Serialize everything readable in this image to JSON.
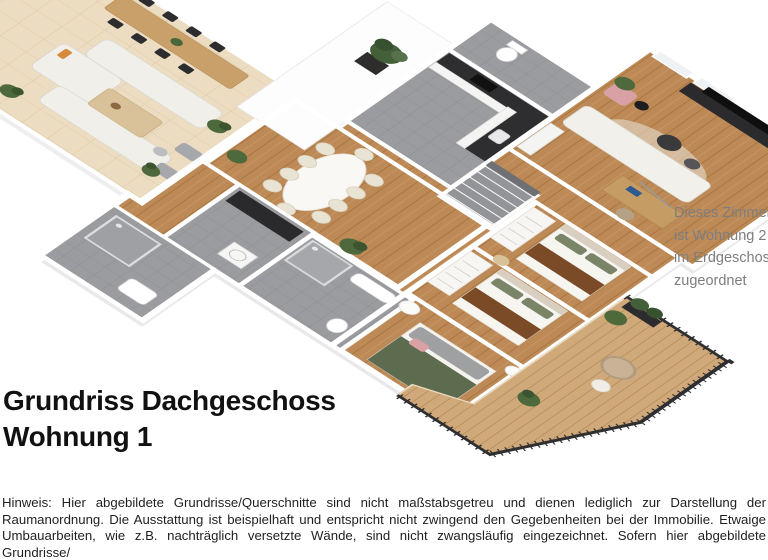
{
  "title": {
    "line1": "Grundriss Dachgeschoss",
    "line2": "Wohnung 1"
  },
  "annotation": {
    "lines": [
      "Dieses Zimmer",
      "ist Wohnung 2",
      "im Erdgeschoss",
      "zugeordnet"
    ]
  },
  "disclaimer": {
    "text": "Hinweis: Hier abgebildete Grundrisse/Querschnitte sind nicht maßstabsgetreu und dienen lediglich zur Darstellung der Raumanordnung. Die Ausstattung ist beispielhaft und entspricht nicht zwingend den Gegebenheiten bei der Immobilie. Etwaige Umbauarbeiten, wie z.B. nachträglich versetzte Wände, sind nicht zwangsläufig eingezeichnet. Sofern hier abgebildete Grundrisse/"
  },
  "palette": {
    "title_color": "#111111",
    "annotation_color": "#7e7e7e",
    "body_color": "#1f1f1f",
    "background": "#ffffff",
    "leader_color": "#9a9a9a",
    "wood_floor": "#bd8a57",
    "terrace_tile": "#ecddc2",
    "gray_floor": "#9b9ca0",
    "deck_wood": "#d0a97a",
    "railing": "#2f2f31",
    "wall": "#ffffff",
    "bed_runner": "#7b4b28",
    "pillow_green": "#7a8467",
    "blanket_green": "#5d6b4e",
    "accent_pink": "#d9a1a6",
    "plant_green": "#4e6a3d",
    "tv_black": "#141414"
  }
}
